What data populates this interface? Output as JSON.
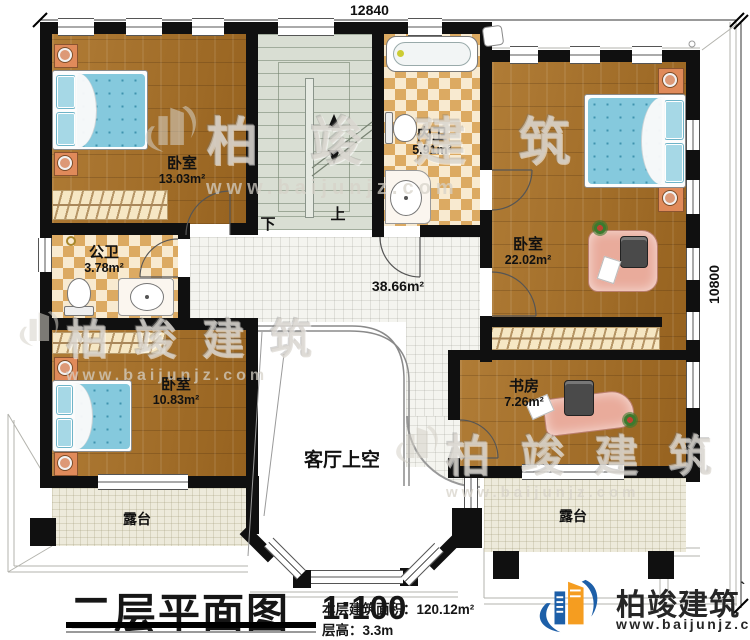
{
  "dimensions": {
    "width": "12840",
    "height": "10800"
  },
  "rooms": {
    "bedroom_top_left": {
      "name": "卧室",
      "area": "13.03m²"
    },
    "inner_bath": {
      "name": "内卫",
      "area": "5.91m²"
    },
    "bedroom_right": {
      "name": "卧室",
      "area": "22.02m²"
    },
    "public_bath": {
      "name": "公卫",
      "area": "3.78m²"
    },
    "bedroom_bottom_left": {
      "name": "卧室",
      "area": "10.83m²"
    },
    "study": {
      "name": "书房",
      "area": "7.26m²"
    },
    "hall": {
      "area": "38.66m²"
    },
    "living_room_void": {
      "name": "客厅上空"
    },
    "terrace_left": {
      "name": "露台"
    },
    "terrace_right": {
      "name": "露台"
    }
  },
  "stairs": {
    "down_label": "下",
    "up_label": "上"
  },
  "title_block": {
    "title": "二层平面图",
    "scale": "1:100",
    "floor_area": "本层建筑面积：120.12m²",
    "floor_height": "层高：3.3m"
  },
  "branding": {
    "company": "柏竣建筑",
    "company_mark": "`",
    "website": "www.baijunjz.com"
  },
  "colors": {
    "wall": "#101010",
    "wood": "#a5702c",
    "tile_light": "#f8ead0",
    "tile_dark": "#dcaa62",
    "bed": "#85c9dd",
    "logo_blue": "#1d5fa8",
    "logo_orange": "#f59d20"
  }
}
